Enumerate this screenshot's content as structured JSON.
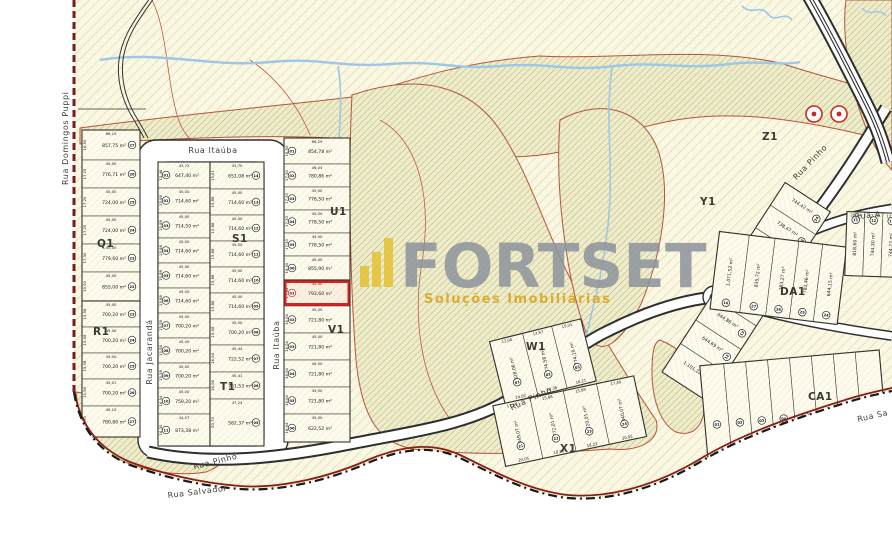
{
  "watermark": {
    "brand": "FORTSET",
    "tagline": "Soluções Imobiliárias"
  },
  "streets": {
    "domingos_puppi": "Rua Domingos Puppi",
    "itauba_top": "Rua Itaúba",
    "itauba_side": "Rua Itaúba",
    "jacaranda": "Rua Jacarandá",
    "pinho_bottom": "Rua Pinho",
    "pinho_mid": "Rua Pinho",
    "pinho_diag": "Rua Pinho",
    "rua_a": "Rua A",
    "salvador": "Rua Salvador",
    "salvador_right": "Rua Sa"
  },
  "highlight": {
    "lot_number": "01",
    "area": "793,60 m²",
    "block": "V1"
  },
  "quadras": [
    "Q1",
    "R1",
    "S1",
    "T1",
    "U1",
    "V1",
    "W1",
    "X1",
    "Y1",
    "Z1",
    "DA1",
    "CA1"
  ],
  "lot_groups": {
    "Q1": [
      {
        "n": "27",
        "a": "857,75 m²",
        "d": "66,15",
        "s": "16,50"
      },
      {
        "n": "26",
        "a": "776,71 m²",
        "d": "45,00",
        "s": "17,25"
      },
      {
        "n": "25",
        "a": "724,00 m²",
        "d": "45,00",
        "s": "17,20"
      },
      {
        "n": "24",
        "a": "724,00 m²",
        "d": "45,00",
        "s": "17,20"
      },
      {
        "n": "23",
        "a": "779,60 m²",
        "d": "45,00",
        "s": "17,30"
      },
      {
        "n": "22",
        "a": "855,00 m²",
        "d": "45,00",
        "s": "19,00"
      }
    ],
    "R1": [
      {
        "n": "23",
        "a": "700,20 m²",
        "d": "45,00",
        "s": "15,58"
      },
      {
        "n": "24",
        "a": "700,20 m²",
        "d": "45,00",
        "s": "15,58"
      },
      {
        "n": "25",
        "a": "700,20 m²",
        "d": "45,00",
        "s": "15,58"
      },
      {
        "n": "26",
        "a": "700,20 m²",
        "d": "45,01",
        "s": "15,58"
      },
      {
        "n": "27",
        "a": "780,80 m²",
        "d": "45,10",
        "s": "16,30"
      }
    ],
    "S1_left": [
      {
        "n": "01",
        "a": "647,40 m²",
        "d": "43,72",
        "s": "15,46"
      },
      {
        "n": "02",
        "a": "714,60 m²",
        "d": "45,00",
        "s": "15,88"
      },
      {
        "n": "03",
        "a": "714,50 m²",
        "d": "45,00",
        "s": "15,88"
      },
      {
        "n": "04",
        "a": "714,60 m²",
        "d": "45,00",
        "s": "15,88"
      },
      {
        "n": "05",
        "a": "714,60 m²",
        "d": "45,00",
        "s": "15,88"
      },
      {
        "n": "06",
        "a": "714,60 m²",
        "d": "45,00",
        "s": "15,88"
      },
      {
        "n": "07",
        "a": "700,20 m²",
        "d": "45,00",
        "s": "15,58"
      },
      {
        "n": "08",
        "a": "700,20 m²",
        "d": "45,00",
        "s": "15,58"
      },
      {
        "n": "09",
        "a": "700,20 m²",
        "d": "45,00",
        "s": "15,58"
      },
      {
        "n": "10",
        "a": "759,20 m²",
        "d": "45,00",
        "s": "16,54"
      },
      {
        "n": "11",
        "a": "873,38 m²",
        "d": "44,07",
        "s": "16,30"
      }
    ],
    "S1_right": [
      {
        "n": "14",
        "a": "651,08 m²",
        "d": "43,70",
        "s": "15,61"
      },
      {
        "n": "13",
        "a": "714,60 m²",
        "d": "45,00",
        "s": "15,88"
      },
      {
        "n": "12",
        "a": "714,60 m²",
        "d": "45,00",
        "s": "15,88"
      },
      {
        "n": "11",
        "a": "714,60 m²",
        "d": "45,00",
        "s": "15,88"
      },
      {
        "n": "10",
        "a": "714,60 m²",
        "d": "45,00",
        "s": "15,88"
      },
      {
        "n": "09",
        "a": "714,60 m²",
        "d": "45,00",
        "s": "15,88"
      },
      {
        "n": "08",
        "a": "700,20 m²",
        "d": "45,00",
        "s": "15,58"
      },
      {
        "n": "07",
        "a": "722,52 m²",
        "d": "45,44",
        "s": "16,04"
      },
      {
        "n": "06",
        "a": "761,53 m²",
        "d": "45,41",
        "s": "16,06"
      },
      {
        "n": "05",
        "a": "582,37 m²",
        "d": "47,24",
        "s": "50,70"
      }
    ],
    "U1": [
      {
        "n": "01",
        "a": "854,78 m²",
        "d": "66,29",
        "s": "16,50"
      },
      {
        "n": "02",
        "a": "780,86 m²",
        "d": "46,04",
        "s": "17,30"
      },
      {
        "n": "03",
        "a": "778,50 m²",
        "d": "45,00",
        "s": "17,30"
      },
      {
        "n": "04",
        "a": "778,50 m²",
        "d": "45,00",
        "s": "17,30"
      },
      {
        "n": "05",
        "a": "778,50 m²",
        "d": "45,00",
        "s": "17,30"
      },
      {
        "n": "06",
        "a": "855,90 m²",
        "d": "45,00",
        "s": "18,00"
      }
    ],
    "V1": [
      {
        "n": "01",
        "a": "793,60 m²",
        "d": "45,00",
        "s": "17,64",
        "hl": true
      },
      {
        "n": "02",
        "a": "721,80 m²",
        "d": "45,00",
        "s": "16,04"
      },
      {
        "n": "03",
        "a": "721,80 m²",
        "d": "45,00",
        "s": "16,04"
      },
      {
        "n": "04",
        "a": "721,80 m²",
        "d": "45,00",
        "s": "16,04"
      },
      {
        "n": "05",
        "a": "721,80 m²",
        "d": "45,00",
        "s": "16,04"
      },
      {
        "n": "06",
        "a": "622,52 m²",
        "d": "45,00",
        "s": "16,04"
      }
    ],
    "Y1": [
      {
        "n": "10",
        "a": "1.101,22 m²"
      },
      {
        "n": "12",
        "a": "644,69 m²"
      },
      {
        "n": "13",
        "a": "644,86 m²"
      },
      {
        "n": "15",
        "a": "769,70 m²"
      },
      {
        "n": "21",
        "a": "765,57 m²"
      },
      {
        "n": "22",
        "a": "755,42 m²"
      },
      {
        "n": "23",
        "a": "738,47 m²"
      },
      {
        "n": "24",
        "a": "744,42 m²"
      }
    ],
    "W1": [
      {
        "n": "01",
        "a": "828,06 m²",
        "d": "13,00",
        "b": "24,02"
      },
      {
        "n": "02",
        "a": "774,58 m²",
        "d": "13,87",
        "b": "20,36"
      },
      {
        "n": "03",
        "a": "774,10 m²",
        "d": "15,01",
        "b": "18,21"
      }
    ],
    "X1": [
      {
        "n": "21",
        "a": "849,07 m²",
        "d": "17,48",
        "b": "20,05"
      },
      {
        "n": "22",
        "a": "772,01 m²",
        "d": "15,88",
        "b": "18,23"
      },
      {
        "n": "23",
        "a": "720,01 m²",
        "d": "15,89",
        "b": "18,23"
      },
      {
        "n": "24",
        "a": "840,07 m²",
        "d": "17,49",
        "b": "20,05"
      }
    ],
    "DA1": [
      {
        "n": "16",
        "a": "1.071,52 m²"
      },
      {
        "n": "27",
        "a": "835,72 m²"
      },
      {
        "n": "26",
        "a": "783,27 m²"
      },
      {
        "n": "25",
        "a": "783,46 m²"
      },
      {
        "n": "24",
        "a": "644,15 m²"
      }
    ],
    "E1": [
      {
        "n": "11",
        "a": "818,60 m²",
        "d": "20,24"
      },
      {
        "n": "12",
        "a": "744,30 m²",
        "d": "17,26"
      },
      {
        "n": "13",
        "a": "744,22 m²",
        "d": "17,26"
      }
    ],
    "CA1": [
      {
        "n": "01",
        "b": "15,49"
      },
      {
        "n": "02",
        "b": "14,42"
      },
      {
        "n": "03",
        "b": "14,57"
      },
      {
        "n": "04",
        "b": "14,57"
      },
      {
        "n": "05",
        "b": "14,57"
      },
      {
        "n": "06",
        "b": "14,57"
      },
      {
        "n": "07",
        "b": "14,69"
      },
      {
        "n": "08",
        "b": "15,43"
      }
    ]
  },
  "colors": {
    "highlight_red": "#dd1f1f",
    "boundary_red": "#7a1c1c",
    "contour_red": "#b5543b",
    "stream_blue": "#9cc7e6",
    "hatch_olive": "#b9b272",
    "watermark_gray": "#8d939c",
    "watermark_gold": "#d9a41c"
  }
}
